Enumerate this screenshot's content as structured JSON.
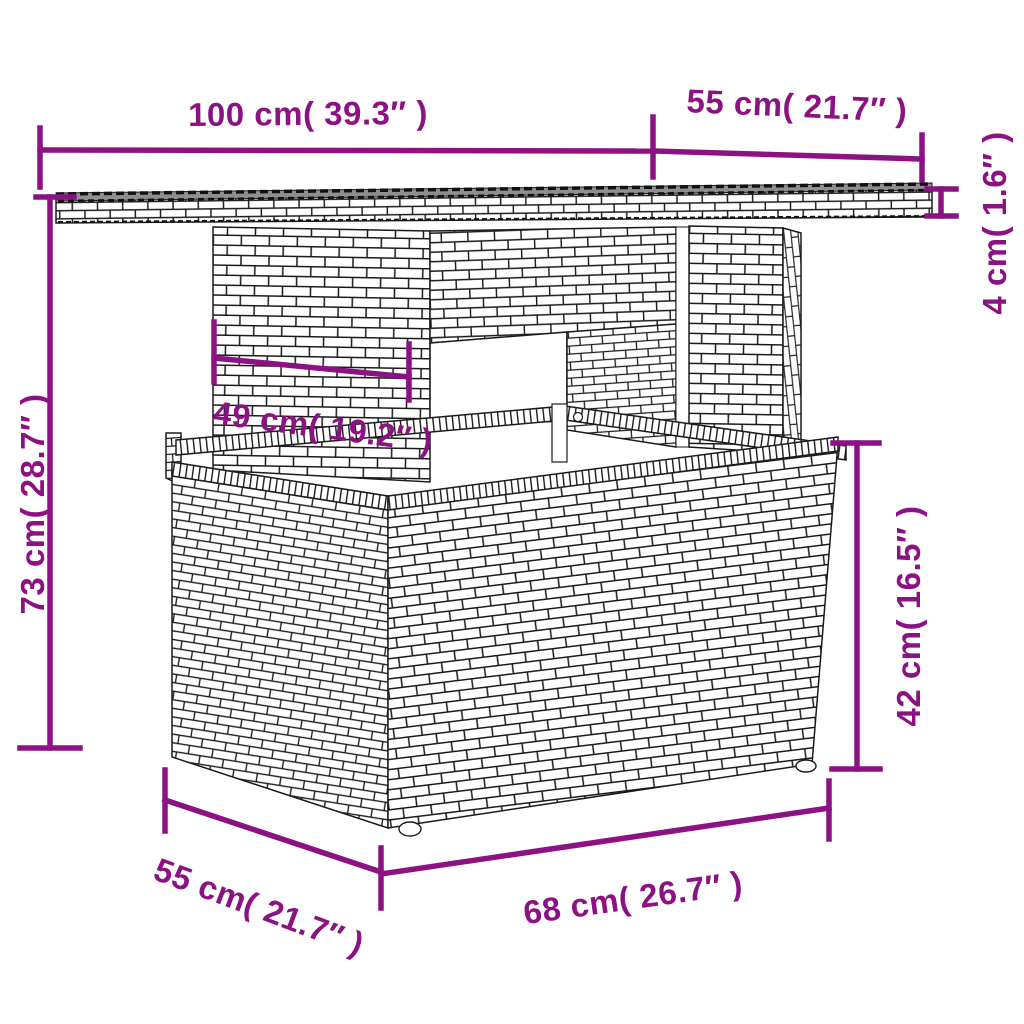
{
  "accent_color": "#8C1283",
  "drawing_line_color": "#1b1b1b",
  "tabletop_surface_color": "#8f8f8f",
  "dims": {
    "top_width": {
      "label": "100 cm( 39.3″ )",
      "value_cm": 100,
      "value_in": 39.3
    },
    "top_depth": {
      "label": "55 cm( 21.7″ )",
      "value_cm": 55,
      "value_in": 21.7
    },
    "top_thickness": {
      "label": "4 cm( 1.6″ )",
      "value_cm": 4,
      "value_in": 1.6
    },
    "total_height": {
      "label": "73 cm( 28.7″ )",
      "value_cm": 73,
      "value_in": 28.7
    },
    "pedestal_width": {
      "label": "49 cm( 19.2″ )",
      "value_cm": 49,
      "value_in": 19.2
    },
    "base_height": {
      "label": "42 cm( 16.5″ )",
      "value_cm": 42,
      "value_in": 16.5
    },
    "base_depth": {
      "label": "55 cm( 21.7″ )",
      "value_cm": 55,
      "value_in": 21.7
    },
    "base_width": {
      "label": "68 cm( 26.7″ )",
      "value_cm": 68,
      "value_in": 26.7
    }
  }
}
